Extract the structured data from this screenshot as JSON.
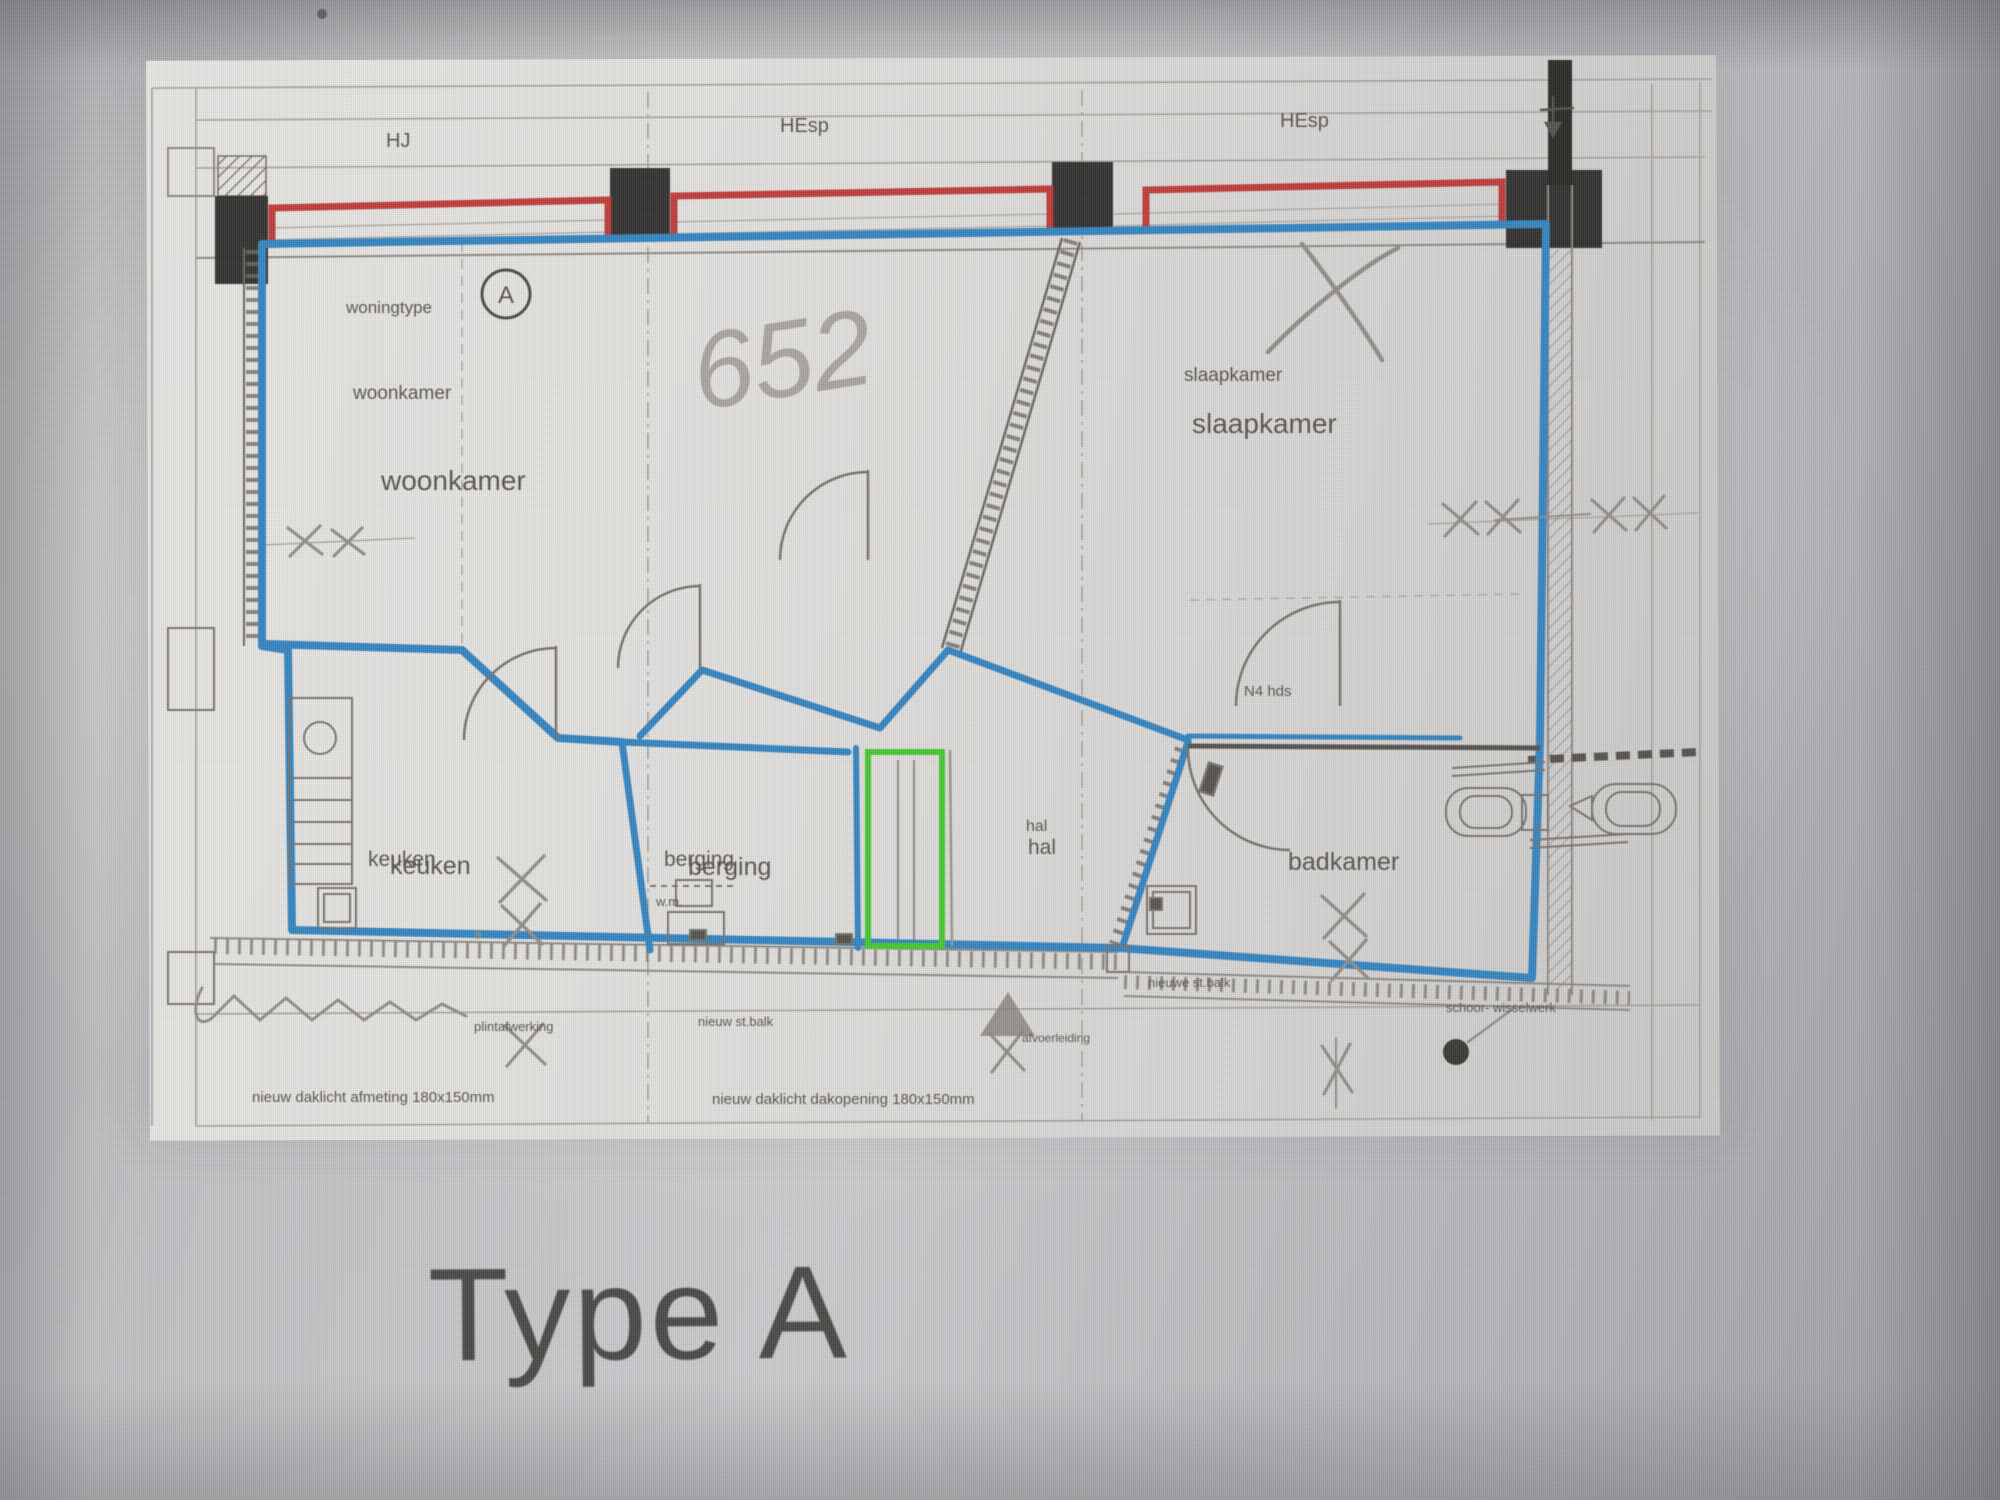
{
  "plan": {
    "grid_labels": {
      "hj": "HJ",
      "hesp1": "HEsp",
      "hesp2": "HEsp"
    },
    "rooms": {
      "woningtype_label": "woningtype",
      "woningtype_code": "A",
      "woonkamer_small": "woonkamer",
      "woonkamer_large": "woonkamer",
      "slaapkamer_small": "slaapkamer",
      "slaapkamer_large": "slaapkamer",
      "keuken_small": "keuken",
      "keuken_large": "keuken",
      "berging_small": "berging",
      "berging_large": "berging",
      "hal_small": "hal",
      "hal_large": "hal",
      "badkamer": "badkamer"
    },
    "annotations": {
      "handwritten_number": "652",
      "door_label": "N4 hds",
      "wm_label": "w.m."
    },
    "notes": {
      "note_keuken": "plintafwerking",
      "beam_note_mid": "nieuw st.balk",
      "beam_note_right": "nieuwe st.balk",
      "daklicht_left": "nieuw daklicht afmeting 180x150mm",
      "daklicht_mid": "nieuw daklicht dakopening 180x150mm",
      "afvoer_note": "afvoerleiding",
      "schoor_note": "schoor- wisselwerk"
    },
    "colors": {
      "wall_highlight_red": "#c8302e",
      "selection_blue": "#2e86c8",
      "selection_green": "#3fcb28",
      "pencil_gray": "#918e8a"
    }
  },
  "caption": {
    "title": "Type A"
  }
}
